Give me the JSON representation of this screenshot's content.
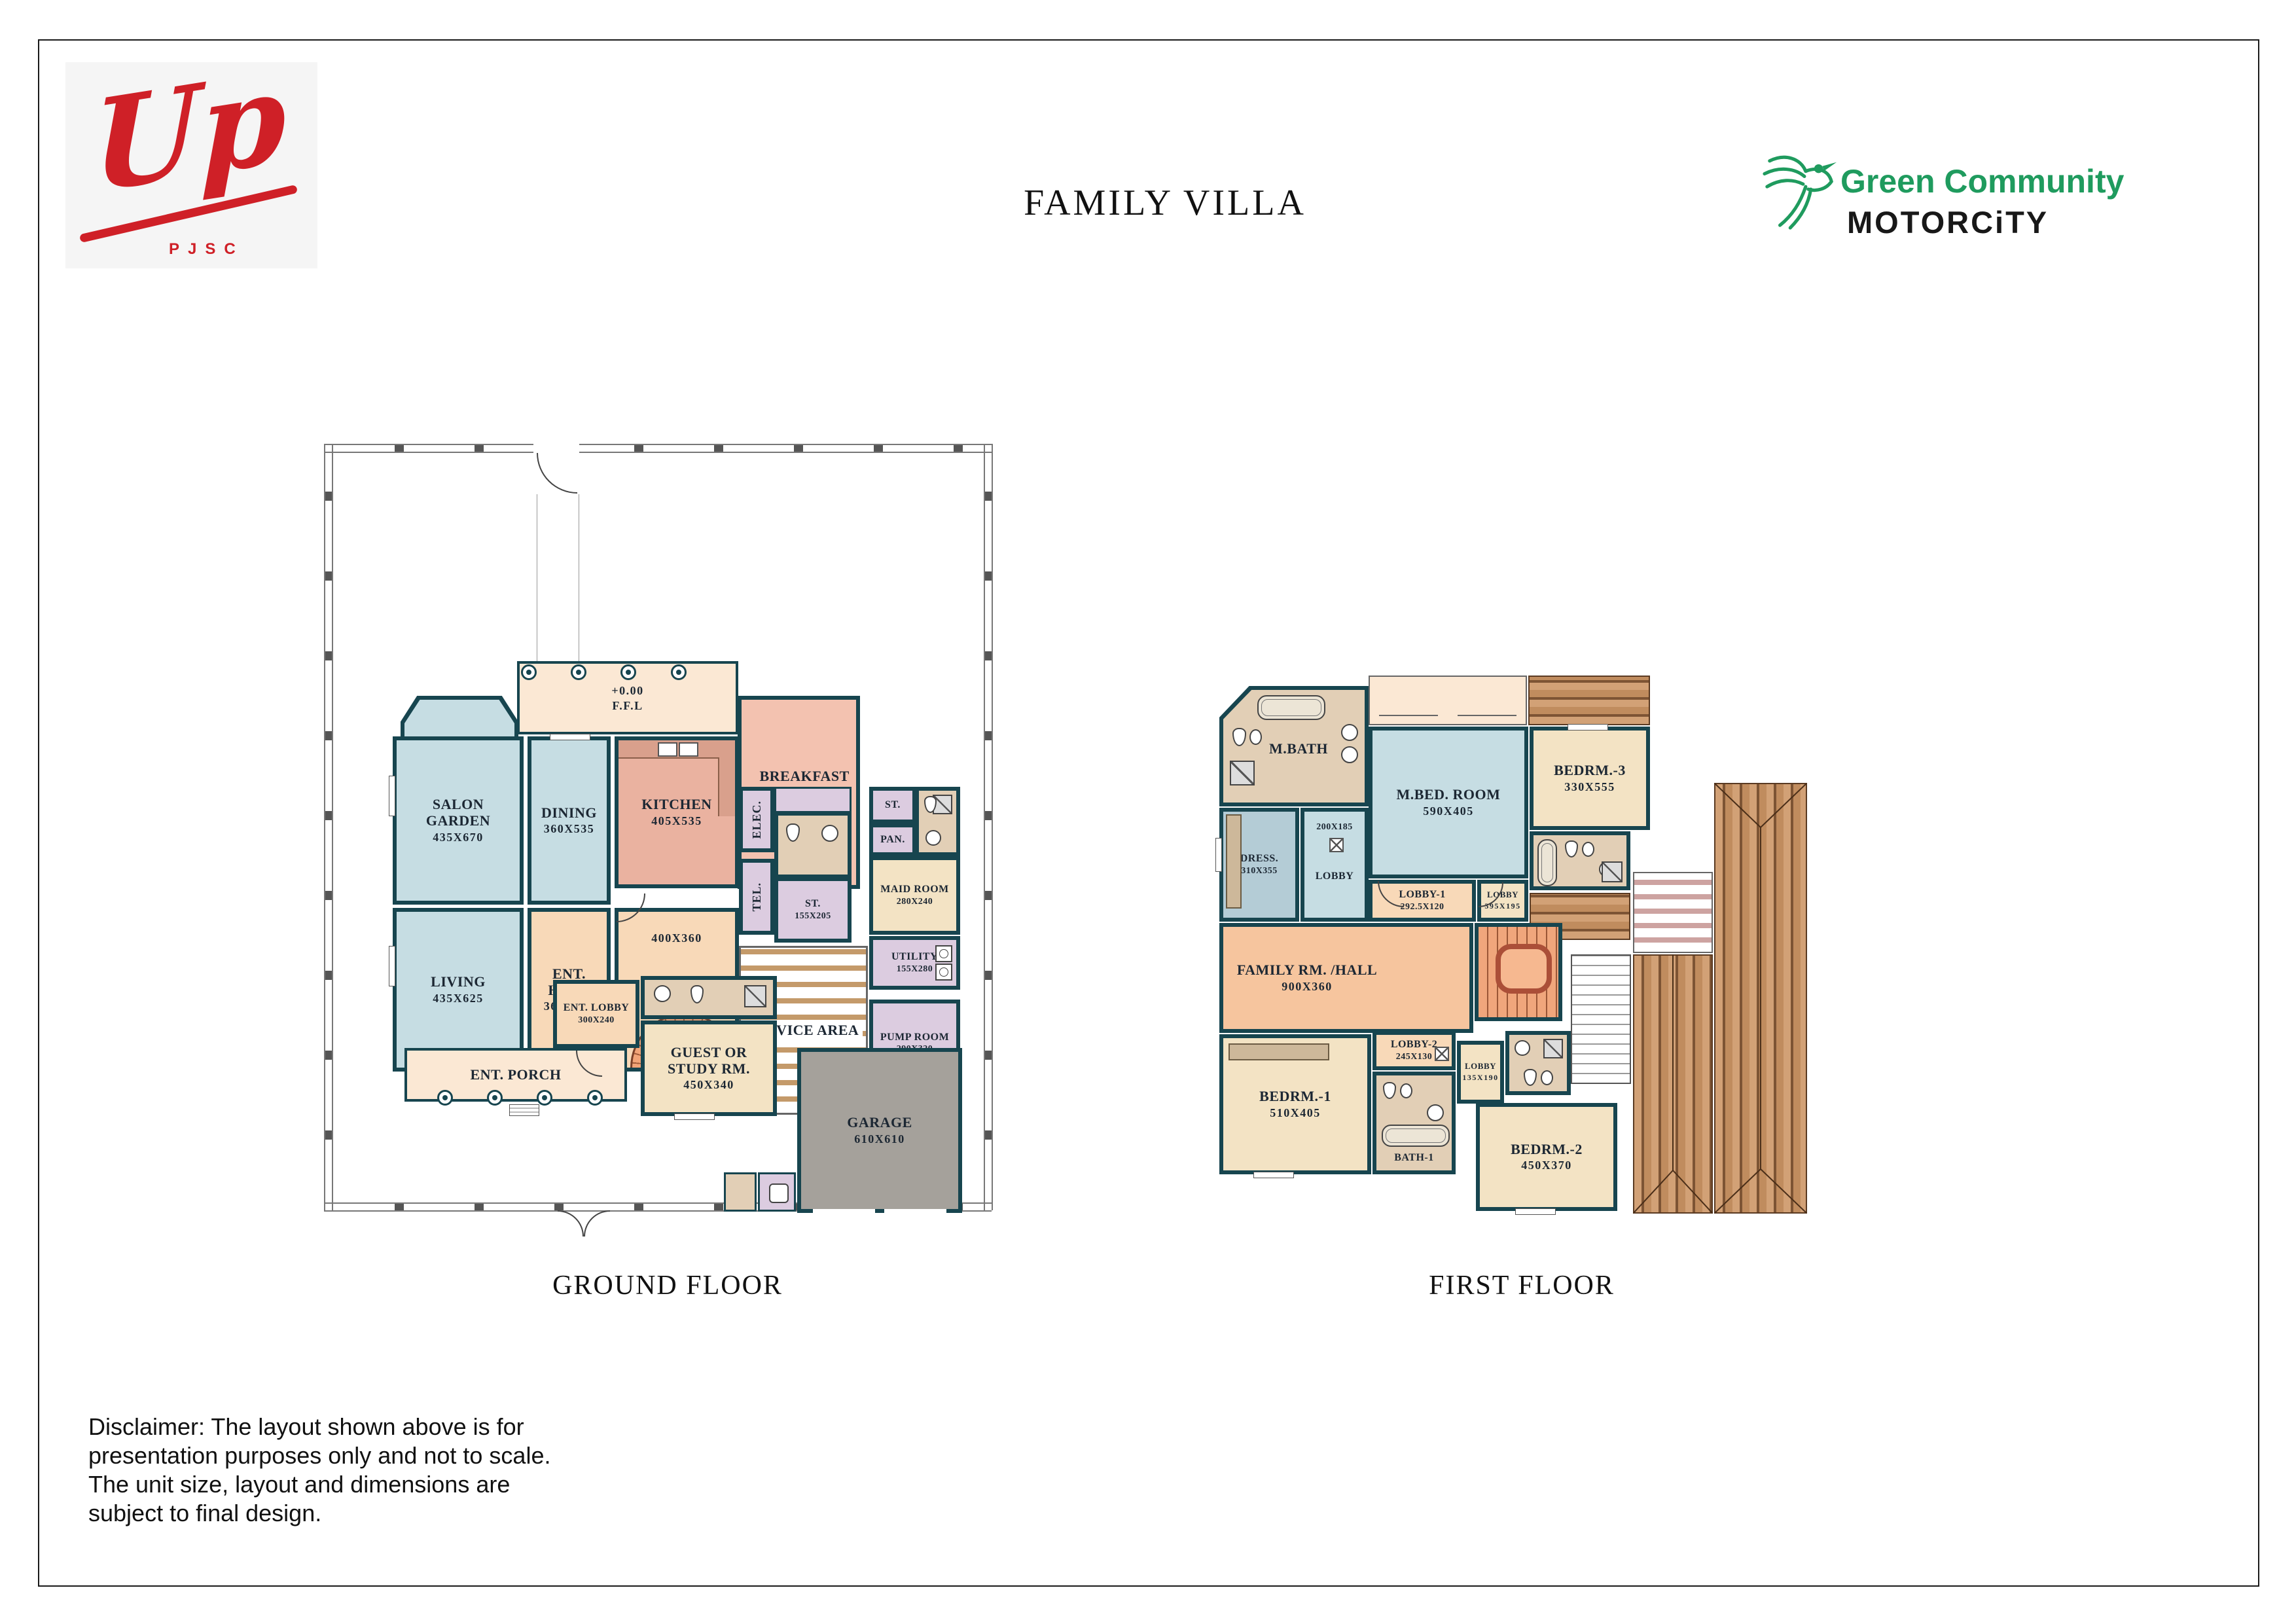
{
  "page": {
    "title": "FAMILY VILLA"
  },
  "brand": {
    "up_logo_text": "Up",
    "up_logo_sub": "PJSC",
    "community_line1": "Green Community",
    "community_line2": "MOTORCiTY"
  },
  "ground_floor": {
    "caption": "GROUND FLOOR",
    "level_mark": "+0.00",
    "level_mark2": "F.F.L",
    "rooms": {
      "salon": {
        "name": "SALON GARDEN",
        "dim": "435X670"
      },
      "dining": {
        "name": "DINING",
        "dim": "360X535"
      },
      "kitchen": {
        "name": "KITCHEN",
        "dim": "405X535"
      },
      "breakfast": {
        "name": "BREAKFAST AREA",
        "dim": "375X575"
      },
      "living": {
        "name": "LIVING",
        "dim": "435X625"
      },
      "ent_hall": {
        "name": "ENT. HALL",
        "dim": "360X360"
      },
      "stair_hall": {
        "dim": "400X360"
      },
      "elec": {
        "name": "ELEC."
      },
      "tel": {
        "name": "TEL."
      },
      "store1": {
        "name": "ST.",
        "dim": "155X205"
      },
      "store2": {
        "name": "ST."
      },
      "pantry": {
        "name": "PAN."
      },
      "maid": {
        "name": "MAID ROOM",
        "dim": "280X240"
      },
      "utility": {
        "name": "UTILITY",
        "dim": "155X280"
      },
      "service": {
        "name": "SERVICE AREA"
      },
      "pump": {
        "name": "PUMP ROOM",
        "dim": "290X320"
      },
      "ent_lobby": {
        "name": "ENT. LOBBY",
        "dim": "300X240"
      },
      "ent_porch": {
        "name": "ENT. PORCH"
      },
      "guest": {
        "name": "GUEST OR STUDY RM.",
        "dim": "450X340"
      },
      "garage": {
        "name": "GARAGE",
        "dim": "610X610"
      }
    }
  },
  "first_floor": {
    "caption": "FIRST FLOOR",
    "rooms": {
      "mbath": {
        "name": "M.BATH"
      },
      "mbed": {
        "name": "M.BED. ROOM",
        "dim": "590X405"
      },
      "bedrm3": {
        "name": "BEDRM.-3",
        "dim": "330X555"
      },
      "dress": {
        "name": "DRESS.",
        "dim": "310X355"
      },
      "closet": {
        "dim": "200X185"
      },
      "lobby": {
        "name": "LOBBY"
      },
      "lobby1": {
        "name": "LOBBY-1",
        "dim": "292.5X120"
      },
      "lobby_mid": {
        "name": "LOBBY",
        "dim": "395X195"
      },
      "family": {
        "name": "FAMILY RM. /HALL",
        "dim": "900X360"
      },
      "bedrm1": {
        "name": "BEDRM.-1",
        "dim": "510X405"
      },
      "lobby2": {
        "name": "LOBBY-2",
        "dim": "245X130"
      },
      "lobby3": {
        "name": "LOBBY",
        "dim": "135X190"
      },
      "bath1": {
        "name": "BATH-1"
      },
      "bedrm2": {
        "name": "BEDRM.-2",
        "dim": "450X370"
      }
    }
  },
  "disclaimer": "Disclaimer: The layout shown above is for presentation purposes only and not to scale. The unit size, layout and dimensions are subject to final design."
}
